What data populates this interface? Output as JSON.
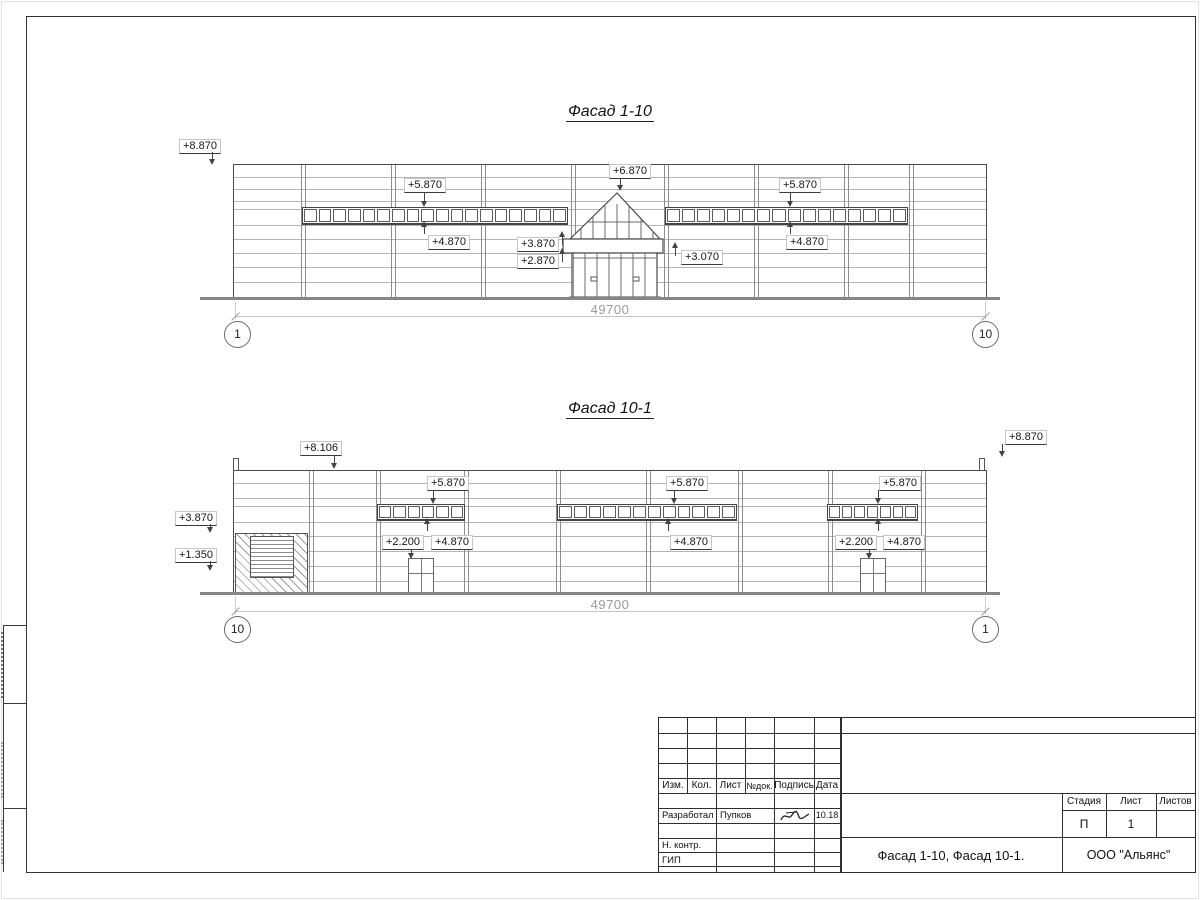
{
  "colors": {
    "line": "#3a3a3a",
    "dim_gray": "#9a9a9a"
  },
  "facade_top": {
    "title": "Фасад 1-10",
    "dimension": "49700",
    "axis_left": "1",
    "axis_right": "10",
    "band_left_panes": 18,
    "band_right_panes": 16,
    "marks": {
      "corner_left": "+8.870",
      "band_left_top": "+5.870",
      "band_left_bottom": "+4.870",
      "gable_peak": "+6.870",
      "canopy_top": "+3.870",
      "canopy_bottom": "+2.870",
      "canopy_right": "+3.070",
      "band_right_top": "+5.870",
      "band_right_bottom": "+4.870"
    }
  },
  "facade_bottom": {
    "title": "Фасад 10-1",
    "dimension": "49700",
    "axis_left": "10",
    "axis_right": "1",
    "band_left_panes": 6,
    "band_mid_panes": 12,
    "band_right_panes": 7,
    "marks": {
      "parapet": "+8.106",
      "corner_right": "+8.870",
      "wall_left": "+3.870",
      "louver": "+1.350",
      "band_left_top": "+5.870",
      "band_left_bottom": "+4.870",
      "door_left": "+2.200",
      "band_mid_top": "+5.870",
      "band_mid_bottom": "+4.870",
      "band_right_top": "+5.870",
      "band_right_bottom": "+4.870",
      "door_right": "+2.200"
    }
  },
  "title_block": {
    "headers": {
      "izm": "Изм.",
      "kol": "Кол.",
      "list": "Лист",
      "ndok": "№док.",
      "podpis": "Подпись",
      "data": "Дата"
    },
    "rows": {
      "razrabotal": "Разработал",
      "n_kontr": "Н. контр.",
      "gip": "ГИП"
    },
    "razrabotal_name": "Пупков",
    "razrabotal_date": "10.18",
    "doc_title": "Фасад 1-10, Фасад 10-1.",
    "company": "ООО \"Альянс\"",
    "stage": {
      "label": "Стадия",
      "value": "П"
    },
    "sheet": {
      "label": "Лист",
      "value": "1"
    },
    "sheets": {
      "label": "Листов",
      "value": ""
    }
  }
}
